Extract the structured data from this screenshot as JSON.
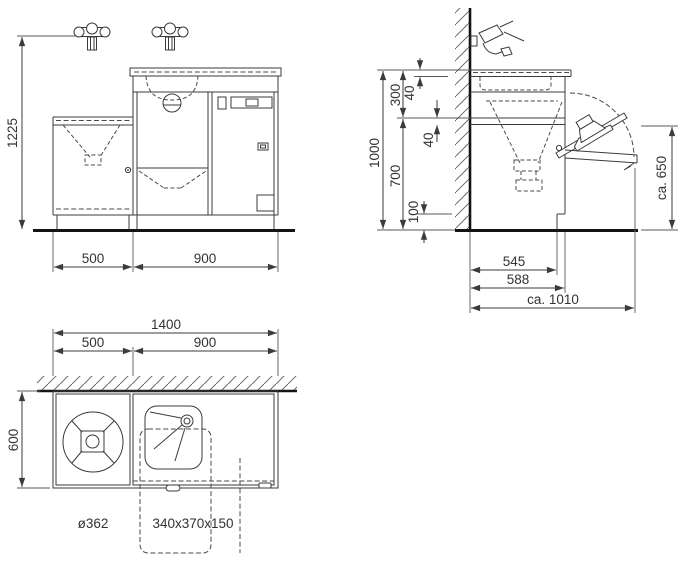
{
  "views": {
    "front": {
      "height": "1225",
      "width_left": "500",
      "width_right": "900"
    },
    "side": {
      "overall_height": "1000",
      "upper": "300",
      "lower": "700",
      "plinth": "100",
      "counter_thickness": "40",
      "shelf_thickness": "40",
      "board_height": "ca. 650",
      "depth_body": "545",
      "depth_overall": "588",
      "depth_extended": "ca. 1010"
    },
    "plan": {
      "total_width": "1400",
      "left_width": "500",
      "right_width": "900",
      "depth": "600",
      "round_basin": "ø362",
      "rect_basin": "340x370x150"
    }
  },
  "colors": {
    "line": "#3b3b3b",
    "thick": "#141414",
    "text": "#333333",
    "background": "#ffffff"
  }
}
